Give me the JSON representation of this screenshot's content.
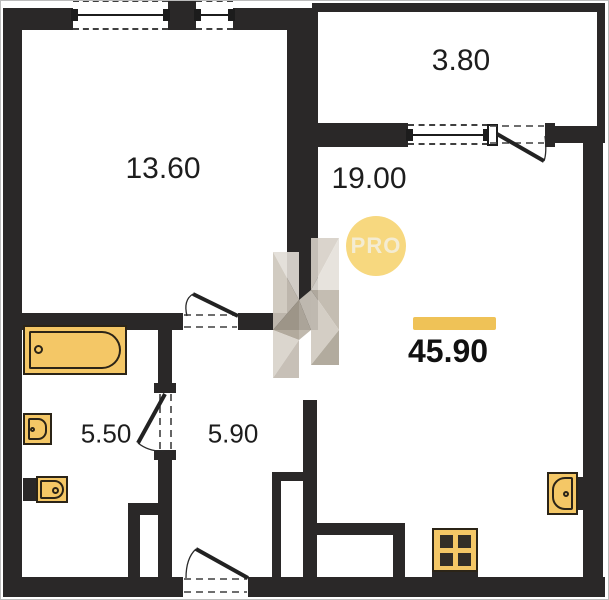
{
  "plan": {
    "type": "apartment-floor-plan",
    "total_area": "45.90",
    "badge_label": "PRO",
    "rooms": [
      {
        "name": "living-room",
        "area": "13.60"
      },
      {
        "name": "balcony",
        "area": "3.80"
      },
      {
        "name": "kitchen-living-room",
        "area": "19.00"
      },
      {
        "name": "bathroom",
        "area": "5.50"
      },
      {
        "name": "hallway",
        "area": "5.90"
      }
    ],
    "fixtures": [
      "bathtub-icon",
      "washbasin-icon",
      "toilet-icon",
      "kitchen-sink-icon",
      "stove-icon"
    ],
    "colors": {
      "wall": "#2a2828",
      "fixture": "#f4c766",
      "fixture_line": "#2b2417",
      "accent": "#efc257",
      "badge_bg": "#f7d87f",
      "badge_text": "#f4ecd2",
      "line": "#3f3f3f",
      "bg": "#ffffff",
      "frame": "#bcbcbc",
      "label": "#1d1d1d"
    }
  }
}
